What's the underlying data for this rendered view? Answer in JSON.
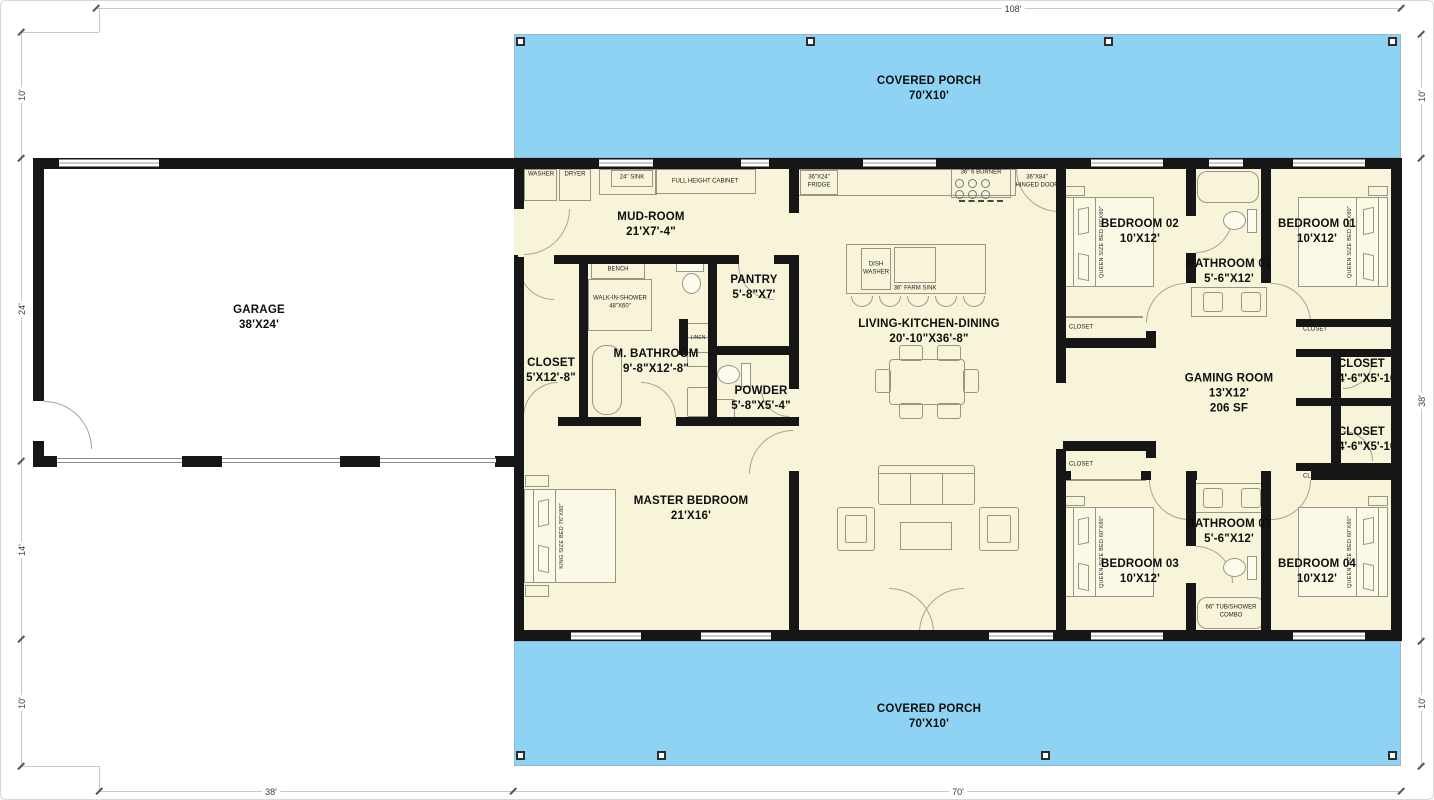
{
  "colors": {
    "porch_blue": "#8fd3f4",
    "floor_beige": "#f8f4d9",
    "wall_black": "#161616",
    "garage_floor": "#ffffff",
    "furniture_line": "#9a9685",
    "dimension_line": "#c8c8c8"
  },
  "rooms": {
    "garage": {
      "name": "GARAGE",
      "size": "38'X24'"
    },
    "porch_top": {
      "name": "COVERED PORCH",
      "size": "70'X10'"
    },
    "porch_bottom": {
      "name": "COVERED PORCH",
      "size": "70'X10'"
    },
    "mudroom": {
      "name": "MUD-ROOM",
      "size": "21'X7'-4\""
    },
    "pantry": {
      "name": "PANTRY",
      "size": "5'-8\"X7'"
    },
    "master_closet": {
      "name": "CLOSET",
      "size": "5'X12'-8\""
    },
    "master_bath": {
      "name": "M. BATHROOM",
      "size": "9'-8\"X12'-8\""
    },
    "powder": {
      "name": "POWDER",
      "size": "5'-8\"X5'-4\""
    },
    "master_bedroom": {
      "name": "MASTER BEDROOM",
      "size": "21'X16'"
    },
    "living": {
      "name": "LIVING-KITCHEN-DINING",
      "size": "20'-10\"X36'-8\""
    },
    "bedroom2": {
      "name": "BEDROOM 02",
      "size": "10'X12'"
    },
    "bath1": {
      "name": "BATHROOM 01",
      "size": "5'-6\"X12'"
    },
    "bedroom1": {
      "name": "BEDROOM 01",
      "size": "10'X12'"
    },
    "gaming": {
      "name": "GAMING ROOM",
      "size": "13'X12'",
      "area": "206 SF"
    },
    "closet_upper": {
      "name": "CLOSET",
      "size": "4'-6\"X5'-10\""
    },
    "closet_lower": {
      "name": "CLOSET",
      "size": "4'-6\"X5'-10\""
    },
    "bath2": {
      "name": "BATHROOM 02",
      "size": "5'-6\"X12'"
    },
    "bedroom3": {
      "name": "BEDROOM 03",
      "size": "10'X12'"
    },
    "bedroom4": {
      "name": "BEDROOM 04",
      "size": "10'X12'"
    }
  },
  "fixtures": {
    "washer": "WASHER",
    "dryer": "DRYER",
    "sink24": "24\" SINK",
    "cabinet": "FULL HEIGHT CABINET",
    "fridge_size": "36\"X24\"",
    "fridge": "FRIDGE",
    "burner": "36\" 6 BURNER",
    "hinged_size": "36\"X84\"",
    "hinged": "HINGED DOOR",
    "dishwasher_1": "DISH",
    "dishwasher_2": "WASHER",
    "farm_sink": "36\" FARM SINK",
    "bench": "BENCH",
    "shower": "WALK-IN-SHOWER",
    "shower_size": "48\"X60\"",
    "linen": "LINEN",
    "closet_small": "CLOSET",
    "king_bed": "KING SIZE BED 76\"X80\"",
    "queen_bed": "QUEEN SIZE BED 60\"X80\"",
    "tub_shower_1": "66\" TUB/SHOWER",
    "tub_shower_2": "COMBO"
  },
  "dimensions": {
    "top": "108'",
    "left": [
      "10'",
      "24'",
      "14'",
      "10'"
    ],
    "right": [
      "10'",
      "38'",
      "10'"
    ],
    "bottom": [
      "38'",
      "70'"
    ]
  }
}
